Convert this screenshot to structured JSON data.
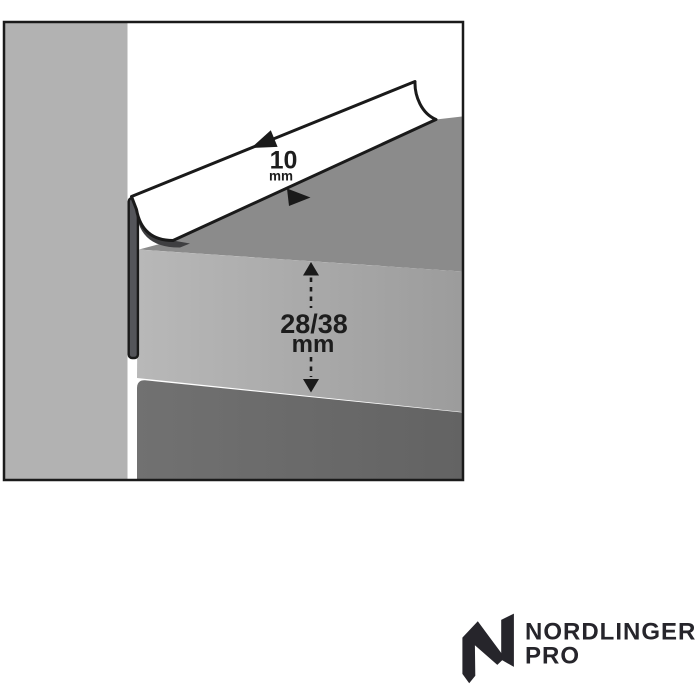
{
  "diagram": {
    "description": "worktop-edge-trim-profile-cross-section",
    "strip_dimension": {
      "value": "10",
      "unit": "mm"
    },
    "thickness_dimension": {
      "value": "28/38",
      "unit": "mm"
    }
  },
  "logo": {
    "brand": "NORDLINGER",
    "sub": "PRO"
  },
  "colors": {
    "wall": "#b2b2b2",
    "worktop_top": "#8b8b8b",
    "front_left": "#b8b8b8",
    "front_right": "#9c9c9c",
    "bottom_left": "#717171",
    "bottom_right": "#636363",
    "flange": "#54555a",
    "wedge": "#3f3f41",
    "strip": "#ffffff",
    "outline": "#1a1a1a",
    "text": "#1d1d1d",
    "logo": "#26252b"
  }
}
